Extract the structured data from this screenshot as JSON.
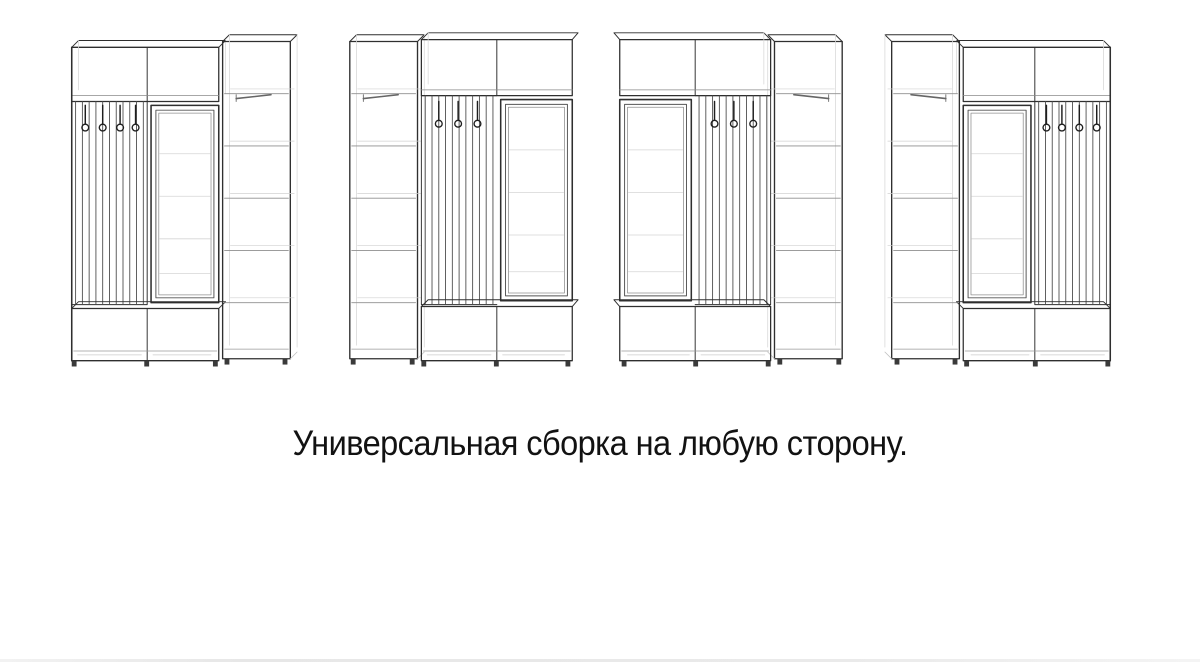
{
  "page": {
    "background": "#ffffff"
  },
  "caption": {
    "text": "Универсальная сборка на любую сторону."
  },
  "colors": {
    "line_dark": "#2f2f2f",
    "line_mid": "#777777",
    "line_faint": "#cfcfcf",
    "caption_text": "#121212",
    "bottom_artifact": "#e9e9e9"
  },
  "drawings": {
    "units": [
      {
        "name": "wardrobe-variant-1-drawing",
        "layout": "layout-a",
        "flipped": false,
        "icon": "hallway-set-hooks-left-mirror-middle-cabinet-right-icon"
      },
      {
        "name": "wardrobe-variant-2-drawing",
        "layout": "layout-b",
        "flipped": false,
        "icon": "hallway-set-cabinet-left-hooks-middle-mirror-right-icon"
      },
      {
        "name": "wardrobe-variant-3-drawing",
        "layout": "layout-b",
        "flipped": true,
        "icon": "hallway-set-mirror-left-hooks-middle-cabinet-right-icon"
      },
      {
        "name": "wardrobe-variant-4-drawing",
        "layout": "layout-a",
        "flipped": true,
        "icon": "hallway-set-cabinet-left-mirror-middle-hooks-right-icon"
      }
    ]
  }
}
